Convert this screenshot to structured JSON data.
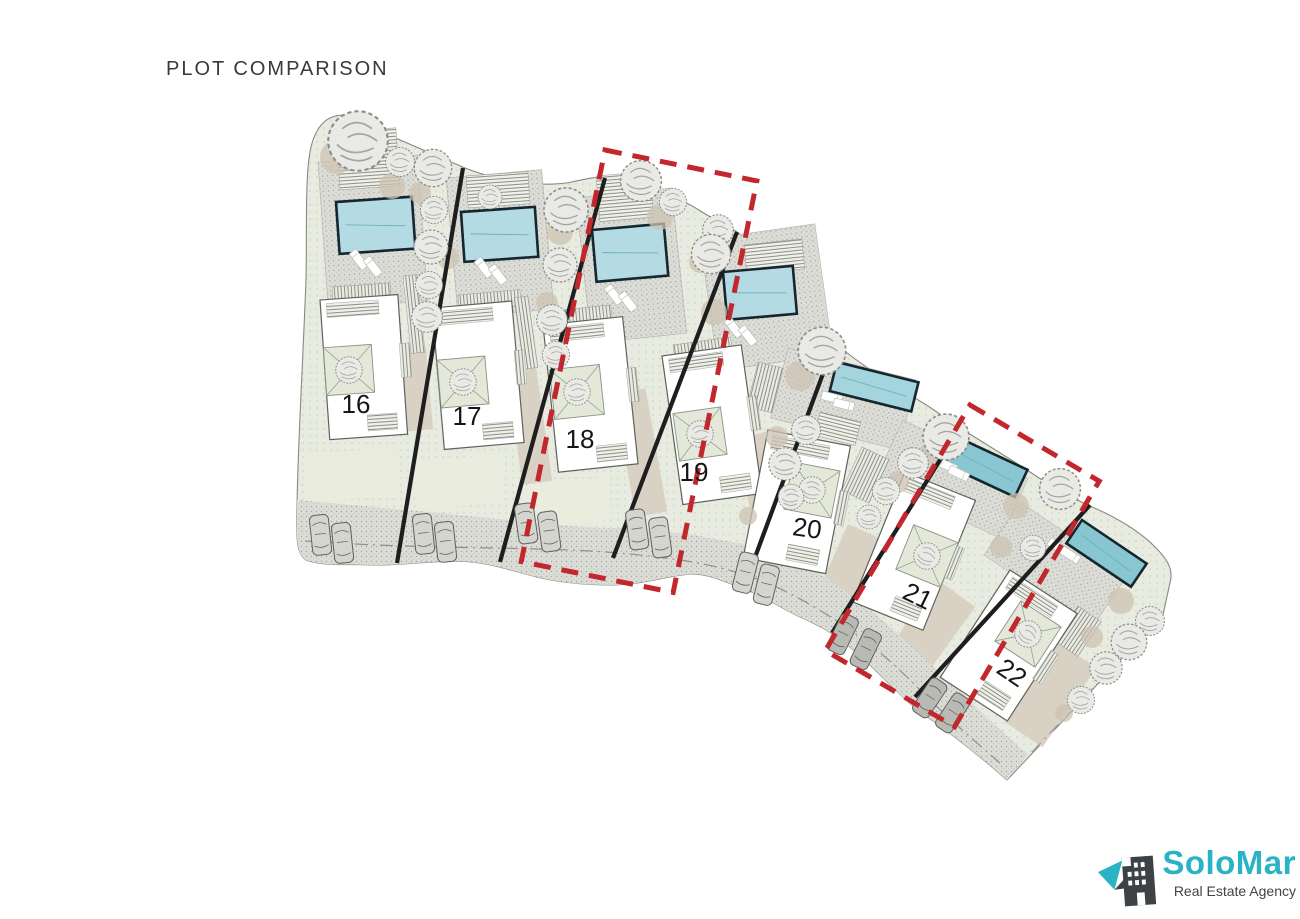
{
  "title": "PLOT COMPARISON",
  "site_plan": {
    "type": "residential-plot-layout",
    "plots": [
      {
        "number": "16",
        "highlighted": false
      },
      {
        "number": "17",
        "highlighted": false
      },
      {
        "number": "18",
        "highlighted": true
      },
      {
        "number": "19",
        "highlighted": false
      },
      {
        "number": "20",
        "highlighted": false
      },
      {
        "number": "21",
        "highlighted": true
      },
      {
        "number": "22",
        "highlighted": false
      }
    ],
    "highlighted_plot_numbers": [
      "18",
      "21"
    ],
    "plot_features": [
      "swimming-pool",
      "sun-loungers",
      "villa",
      "courtyard-tree",
      "parking-cars",
      "garden"
    ]
  },
  "logo": {
    "name": "SoloMar",
    "tagline": "Real Estate Agency",
    "icon": "building-with-pointer-icon"
  },
  "colors": {
    "pool_light": "#b4dbe3",
    "pool_mid": "#a4d5de",
    "pool_dark": "#88c7d2",
    "pool_border": "#15262e",
    "highlight_red": "#c1272d",
    "site_green": "#e7ebe0",
    "paving_gray": "#dcddd7",
    "sand_tan": "#d9d2c4",
    "lawn_green": "#eaedde",
    "divider_black": "#1e1e1e",
    "logo_teal": "#2ab3c4",
    "logo_dark": "#3d4247",
    "title_text": "#3a3a3a"
  }
}
